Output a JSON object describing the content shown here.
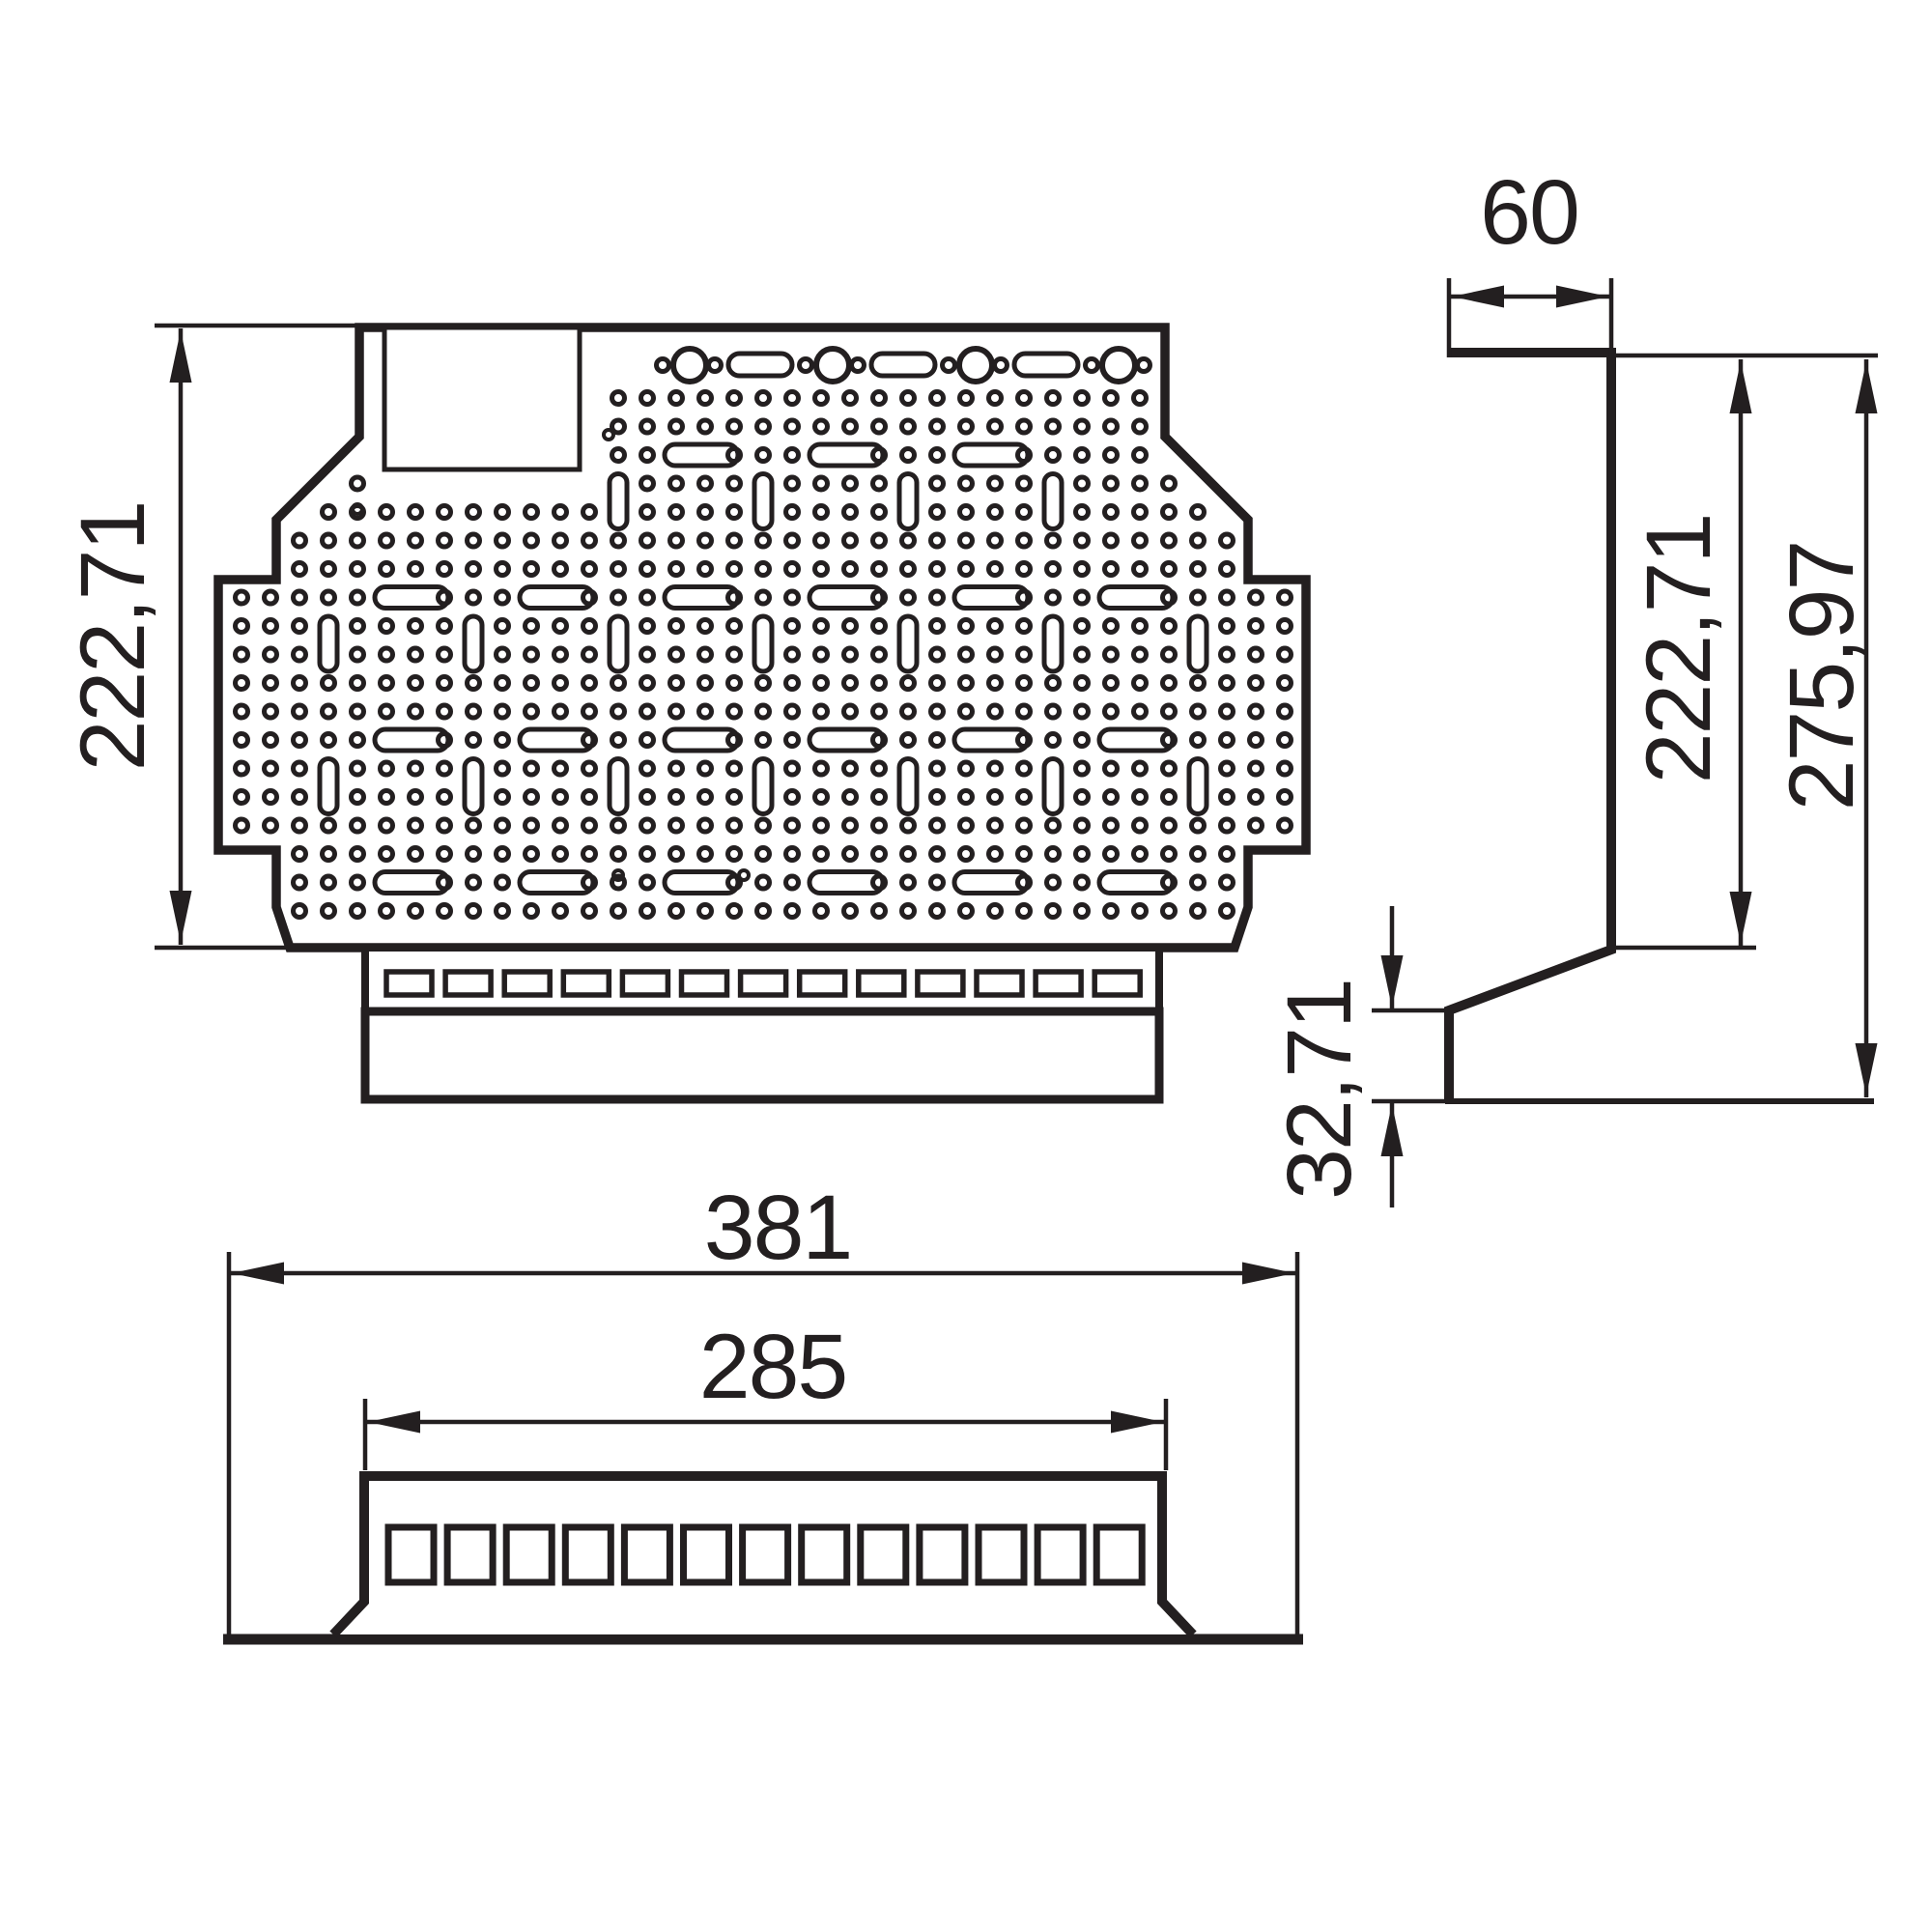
{
  "drawing": {
    "background": "#ffffff",
    "line_color": "#231f20",
    "dimensions": {
      "front_height": "222,71",
      "top_depth": "60",
      "side_plate_height": "222,71",
      "side_total_height": "275,97",
      "foot_height": "32,71",
      "base_width": "381",
      "inner_width": "285"
    },
    "counts": {
      "front_vent_slots": 13,
      "bottom_vent_squares": 13
    }
  }
}
